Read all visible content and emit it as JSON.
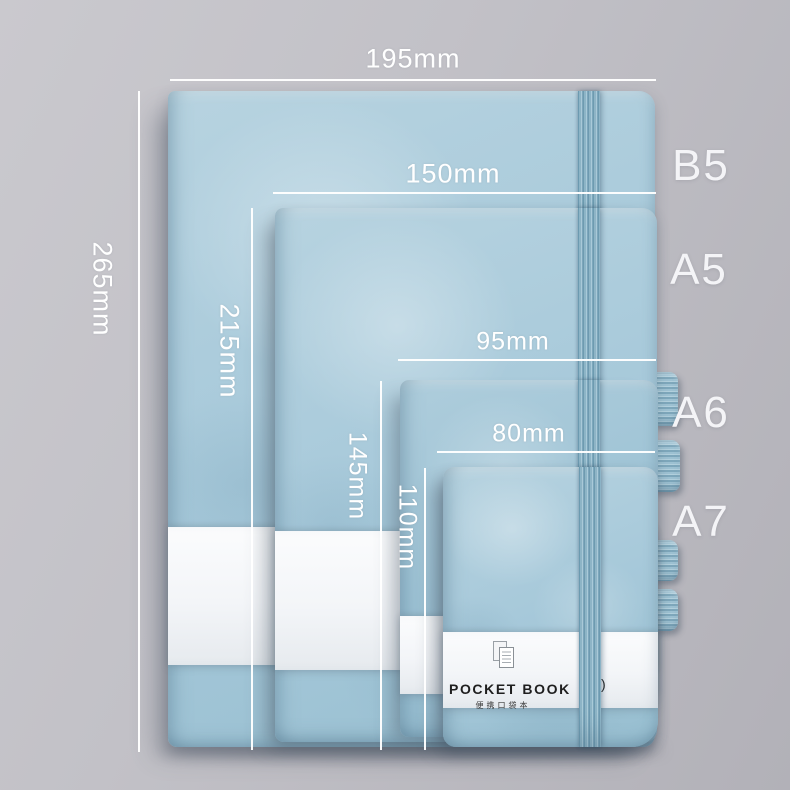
{
  "product": {
    "notebooks": [
      {
        "size_label": "B5",
        "width_label": "195mm",
        "height_label": "265mm"
      },
      {
        "size_label": "A5",
        "width_label": "150mm",
        "height_label": "215mm"
      },
      {
        "size_label": "A6",
        "width_label": "95mm",
        "height_label": "145mm"
      },
      {
        "size_label": "A7",
        "width_label": "80mm",
        "height_label": "110mm"
      }
    ],
    "brand_band": {
      "icon": "pages-icon",
      "title": "POCKET BOOK",
      "subtitle": "便携口袋本",
      "partial_text": ")"
    },
    "colors": {
      "background_gray": "#c1c0c6",
      "cover_blue": "#a7c9da",
      "elastic_blue": "#7fa8bc",
      "band_white": "#f6f7f9",
      "annotation_white": "#ffffff",
      "brand_text": "#1e1e1e"
    }
  }
}
